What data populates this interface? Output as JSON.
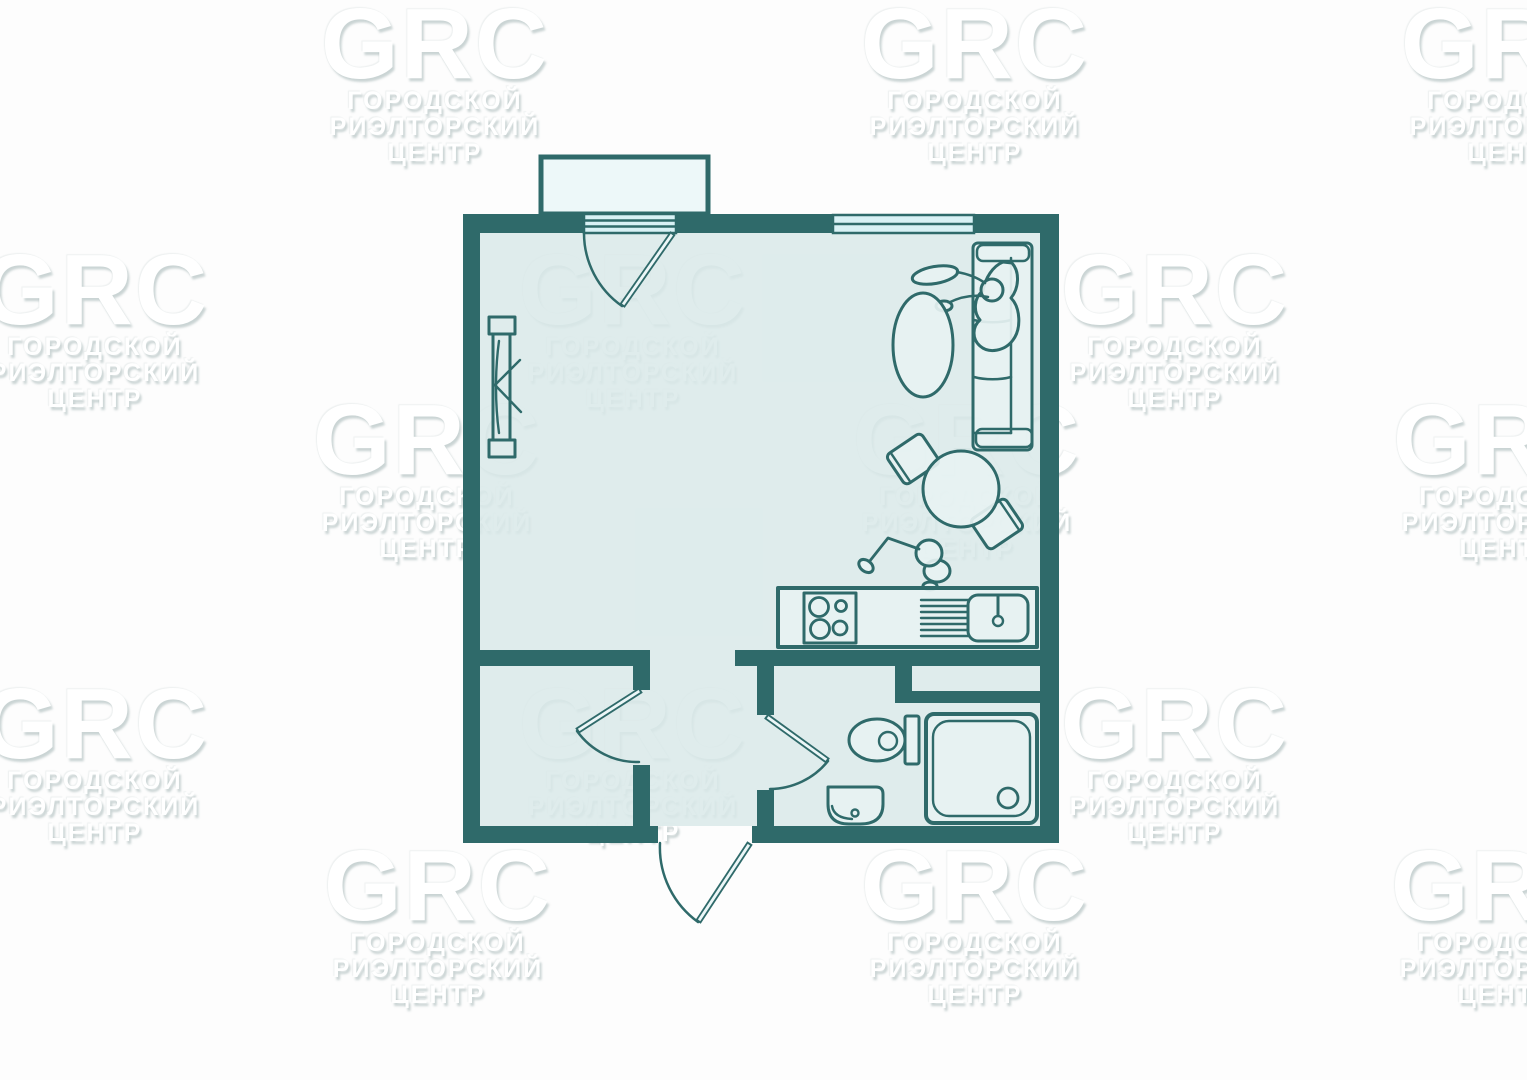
{
  "meta": {
    "kind": "real-estate floor plan",
    "width_px": 1527,
    "height_px": 1080
  },
  "watermark": {
    "logo": "GRC",
    "line1": "ГОРОДСКОЙ",
    "line2": "РИЭЛТОРСКИЙ",
    "line3": "ЦЕНТР"
  },
  "colors": {
    "wall": "#2f6a6a",
    "floor": "#d9e9e9",
    "fixture": "#e7f2f2",
    "balcony": "#ecf7f8",
    "window": "#d8f1f5",
    "background": "#fdfdfd"
  },
  "plan": {
    "rooms": [
      "main-room",
      "hallway",
      "storage-closet",
      "bathroom",
      "balcony"
    ],
    "openings": [
      "balcony-door",
      "window",
      "room-passage",
      "closet-door",
      "bathroom-door",
      "entrance-door"
    ],
    "furniture": [
      "wardrobe",
      "sofa",
      "person-on-sofa",
      "oval-coffee-table",
      "round-dining-table",
      "chair",
      "chair",
      "person-standing",
      "kitchen-counter",
      "stove",
      "drainboard",
      "kitchen-sink"
    ],
    "bathroom_fixtures": [
      "toilet",
      "washbasin",
      "shower-tray"
    ]
  }
}
